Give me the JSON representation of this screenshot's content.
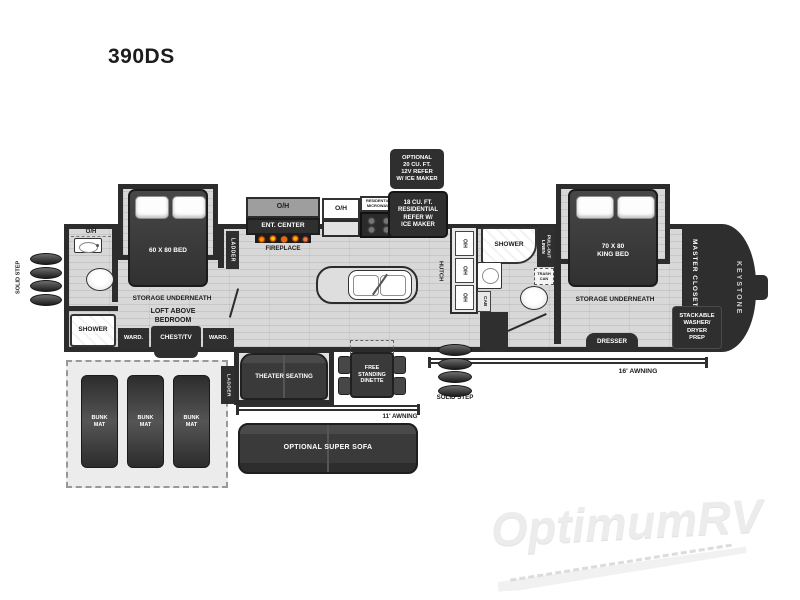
{
  "title": "390DS",
  "watermark": {
    "brand": "OptimumRV"
  },
  "colors": {
    "wall": "#2c2c2c",
    "floor": "#d8d8d8",
    "flame_accent": "#ff8c00"
  },
  "exterior": {
    "solid_step_left": "SOLID STEP",
    "solid_step_right": "SOLID STEP",
    "awning_11": "11' AWNING",
    "awning_16": "16' AWNING",
    "keystone": "KEYSTONE"
  },
  "front_bedroom": {
    "oh": "O/H",
    "bed": "60 X 80 BED",
    "storage": "STORAGE UNDERNEATH",
    "loft": "LOFT ABOVE\nBEDROOM",
    "ward_left": "WARD.",
    "chest_tv": "CHEST/TV",
    "ward_right": "WARD.",
    "ladder": "LADDER"
  },
  "front_bath": {
    "shower": "SHOWER"
  },
  "bunk_room": {
    "mats": [
      "BUNK\nMAT",
      "BUNK\nMAT",
      "BUNK\nMAT"
    ],
    "ladder": "LADDER"
  },
  "entertainment": {
    "oh": "O/H",
    "ent_center": "ENT. CENTER",
    "fireplace": "FIREPLACE"
  },
  "kitchen": {
    "oh": "O/H",
    "microwave": "RESIDENTIAL\nMICROWAVE",
    "refer": "18 CU. FT.\nRESIDENTIAL\nREFER W/\nICE MAKER",
    "optional_refer": "OPTIONAL\n20 CU. FT.\n12V REFER\nW/ ICE MAKER",
    "hutch": "HUTCH",
    "hutch_oh": [
      "O/H",
      "O/H",
      "O/H"
    ]
  },
  "living": {
    "theater_seating": "THEATER SEATING",
    "dinette": "FREE\nSTANDING\nDINETTE",
    "super_sofa": "OPTIONAL SUPER SOFA"
  },
  "rear_bath": {
    "shower": "SHOWER",
    "pullout_linen": "PULL-OUT\nLINEN",
    "trash_can": "TRASH\nCAN",
    "cab": "CAB"
  },
  "master_bedroom": {
    "bed": "70 X 80\nKING BED",
    "storage": "STORAGE UNDERNEATH",
    "dresser": "DRESSER",
    "closet": "MASTER CLOSET",
    "washer_dryer": "STACKABLE\nWASHER/\nDRYER\nPREP"
  }
}
